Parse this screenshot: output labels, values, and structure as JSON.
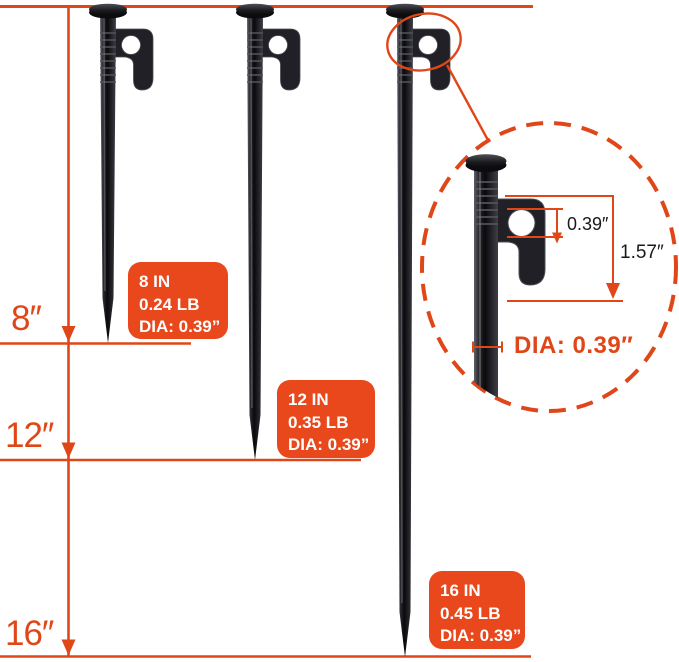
{
  "colors": {
    "accent": "#E04718",
    "label_background": "#E8481C",
    "label_text": "#ffffff",
    "stake_body": "#17171b",
    "dimension_text": "#1a1a1a"
  },
  "side_ruler": {
    "ticks": [
      "8″",
      "12″",
      "16″"
    ]
  },
  "spec_boxes": [
    {
      "length": "8 IN",
      "weight": "0.24 LB",
      "diameter": "DIA: 0.39”"
    },
    {
      "length": "12 IN",
      "weight": "0.35 LB",
      "diameter": "DIA: 0.39”"
    },
    {
      "length": "16 IN",
      "weight": "0.45 LB",
      "diameter": "DIA: 0.39”"
    }
  ],
  "detail_view": {
    "hole_size": "0.39″",
    "head_length": "1.57″",
    "shaft_diameter": "DIA: 0.39″"
  },
  "graphics": {
    "stake_icons": [
      "tent-stake-8in-icon",
      "tent-stake-12in-icon",
      "tent-stake-16in-icon"
    ],
    "callout_icon": "magnified-head-detail-icon"
  }
}
